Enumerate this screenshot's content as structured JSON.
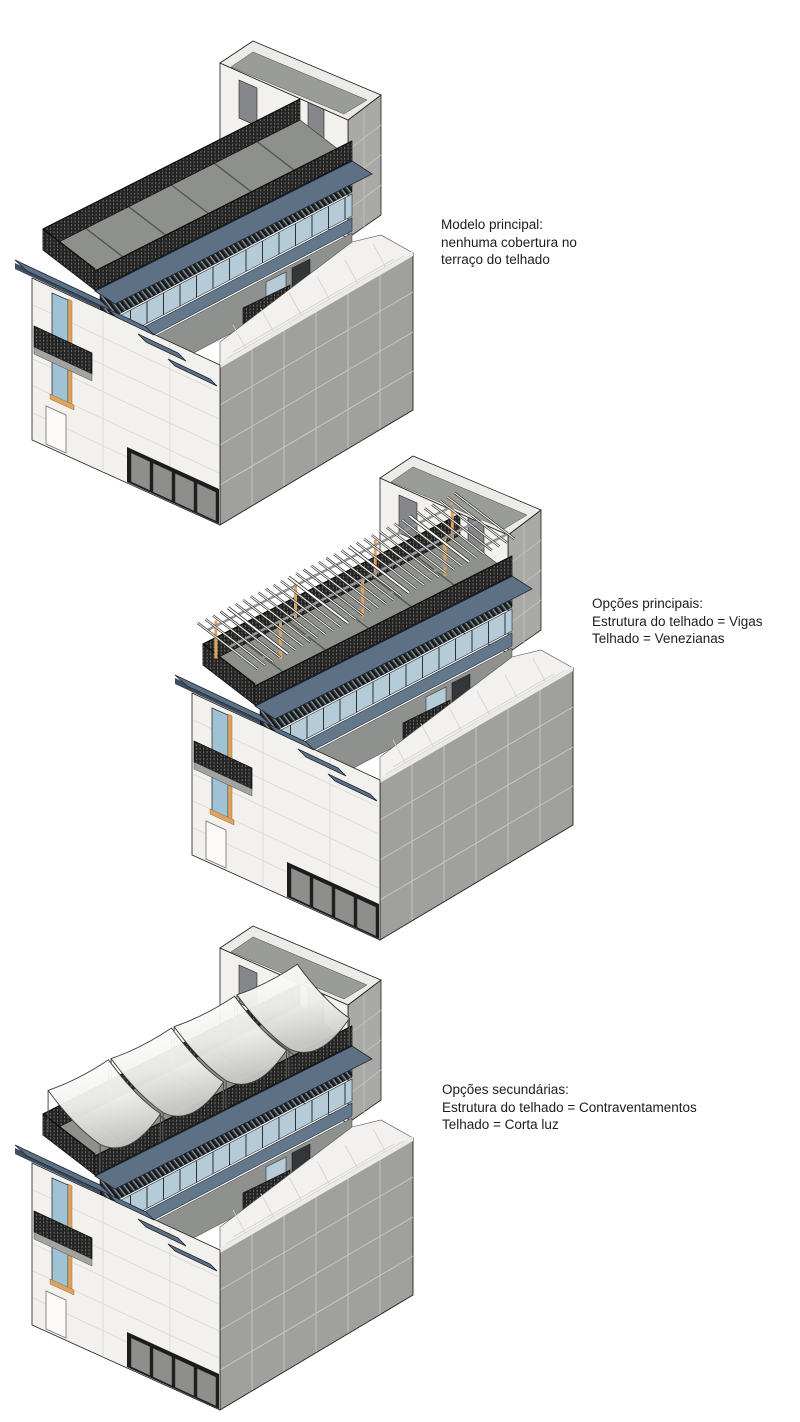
{
  "captions": {
    "modelo_principal": {
      "line1": "Modelo principal:",
      "line2": "nenhuma cobertura no",
      "line3": "terraço do telhado"
    },
    "opcoes_principais": {
      "line1": "Opções principais:",
      "line2": "Estrutura do telhado = Vigas",
      "line3": "Telhado = Venezianas"
    },
    "opcoes_secundarias": {
      "line1": "Opções secundárias:",
      "line2": "Estrutura do telhado = Contraventamentos",
      "line3": "Telhado = Corta luz"
    }
  },
  "palette": {
    "ink": "#1f1f1f",
    "wallWhite": "#f3f1ee",
    "towerGray": "#a9a9a6",
    "capGray": "#9a9c97",
    "terrGray": "#8e908b",
    "parapet": "#a0a19d",
    "floorW": "#f2f1ef",
    "slate": "#5e7184",
    "slateB": "#64788b",
    "slateDark": "#3d4c5e",
    "glass": "#b5cbd7",
    "tan": "#dfa35f",
    "meshDark": "#232323",
    "meshDot": "#6e6e6a",
    "louvBase": "#3a4145",
    "louvDark": "#15181b",
    "louvLight": "#9aa3a8",
    "sailShade": "#c9c9c5"
  }
}
